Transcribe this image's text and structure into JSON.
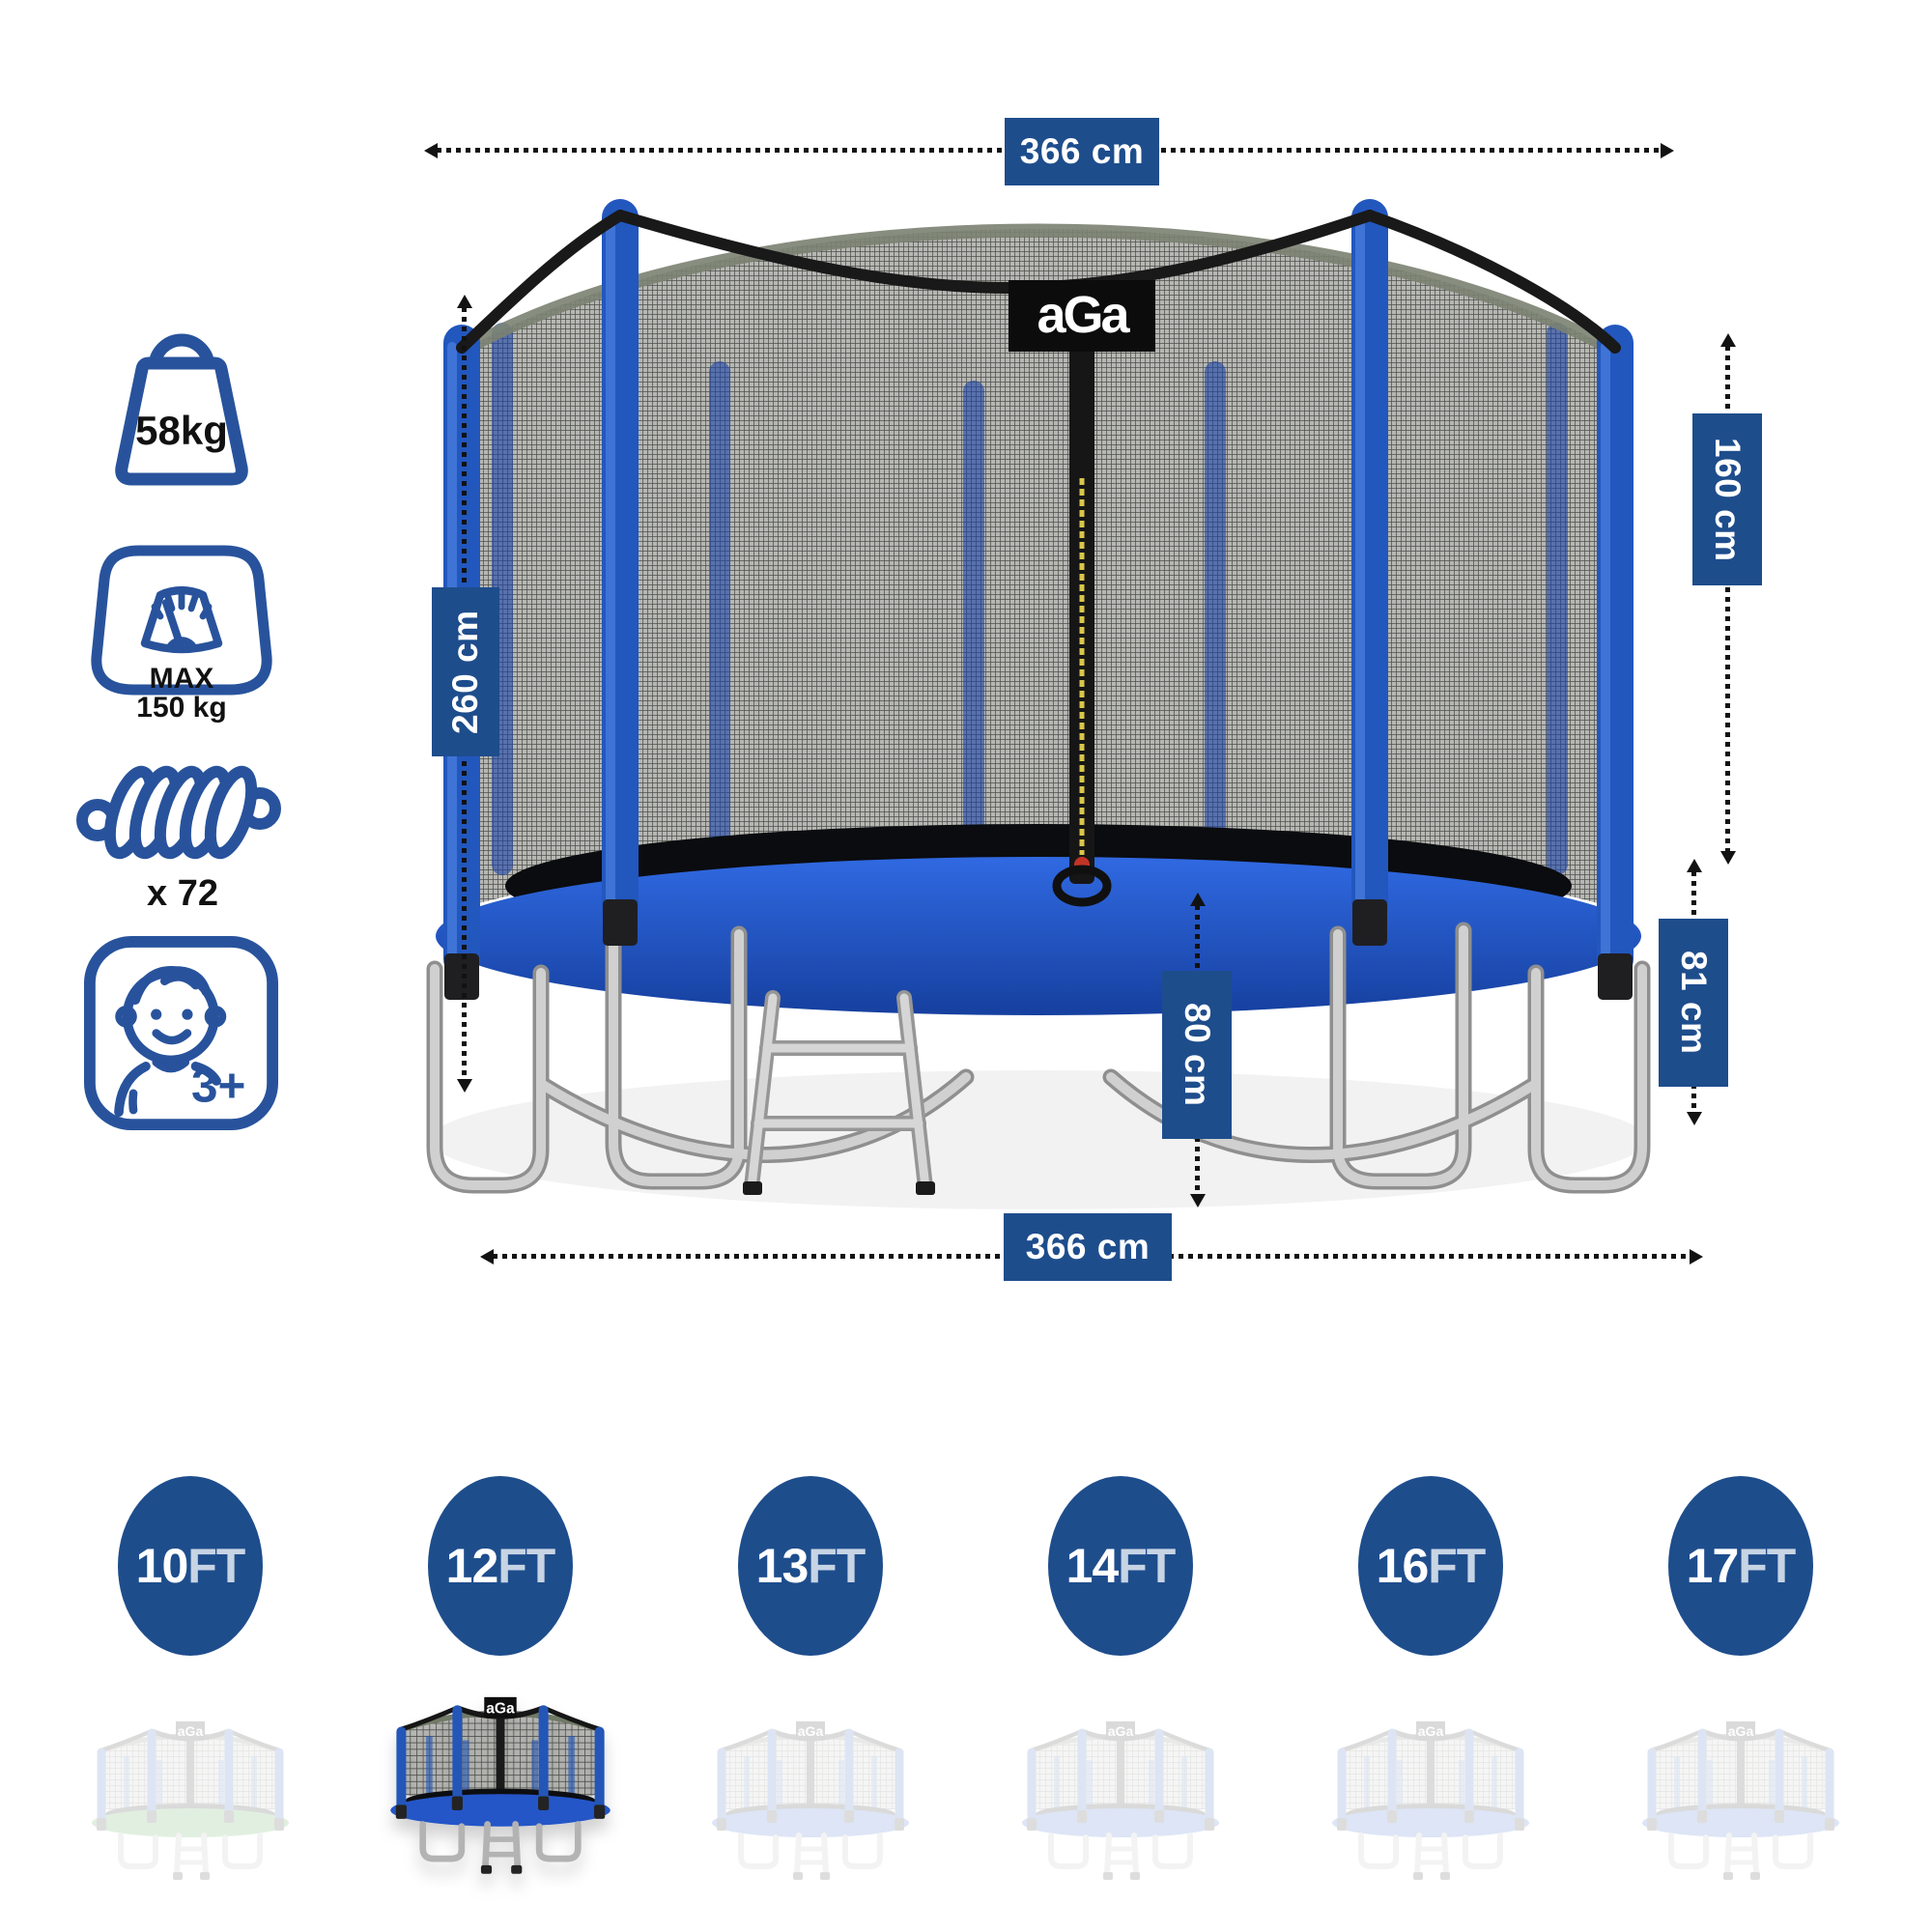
{
  "brand": "aGa",
  "specs": [
    {
      "name": "item-weight",
      "label": "58kg"
    },
    {
      "name": "max-user-load",
      "label_line1": "MAX",
      "label_line2": "150 kg"
    },
    {
      "name": "springs-count",
      "label": "x 72"
    },
    {
      "name": "age-recommendation",
      "label": "3+"
    }
  ],
  "measurements": {
    "top_width": "366 cm",
    "total_height": "260 cm",
    "net_height": "160 cm",
    "frame_height": "81 cm",
    "ladder_height": "80 cm",
    "bottom_width": "366 cm"
  },
  "sizes": [
    {
      "value": "10",
      "unit": "FT",
      "selected": false
    },
    {
      "value": "12",
      "unit": "FT",
      "selected": true
    },
    {
      "value": "13",
      "unit": "FT",
      "selected": false
    },
    {
      "value": "14",
      "unit": "FT",
      "selected": false
    },
    {
      "value": "16",
      "unit": "FT",
      "selected": false
    },
    {
      "value": "17",
      "unit": "FT",
      "selected": false
    }
  ],
  "colors": {
    "accent": "#1e4d8c",
    "icon_blue": "#28539c",
    "pad_blue": "#2456c8",
    "ghost_pad_green": "#3f9a3a",
    "size_unit_label": "#c7d4e4"
  }
}
